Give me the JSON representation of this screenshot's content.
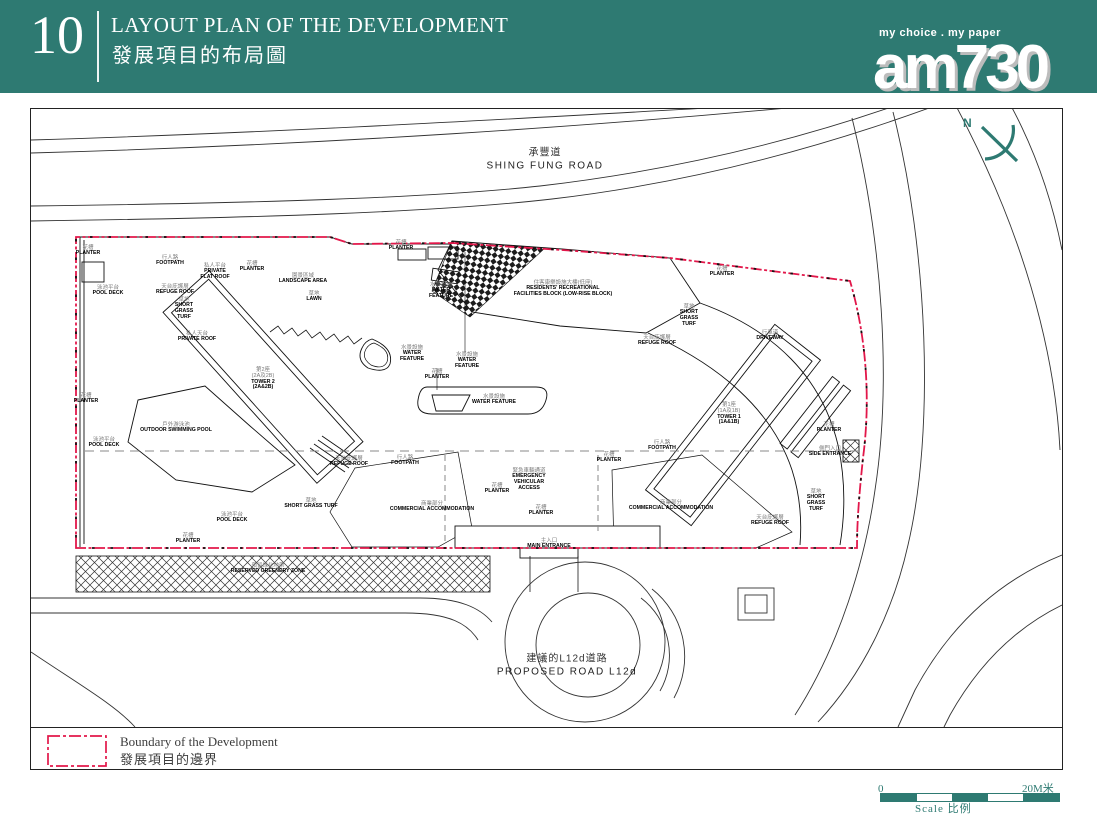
{
  "header": {
    "page_number": "10",
    "title_en": "LAYOUT PLAN OF THE DEVELOPMENT",
    "title_zh": "發展項目的布局圖",
    "tagline": "my choice . my paper",
    "logo_text": "am730"
  },
  "plan": {
    "north_label": "N",
    "road_labels": [
      {
        "zh": "承豐道",
        "en": "SHING FUNG ROAD",
        "x": 545,
        "y": 160
      },
      {
        "zh": "建議的L12d道路",
        "en": "PROPOSED ROAD L12d",
        "x": 567,
        "y": 666
      }
    ],
    "labels": [
      {
        "zh": "花槽",
        "en": "PLANTER",
        "x": 88,
        "y": 251
      },
      {
        "zh": "泳池平台",
        "en": "POOL DECK",
        "x": 108,
        "y": 291
      },
      {
        "zh": "行人路",
        "en": "FOOTPATH",
        "x": 170,
        "y": 261
      },
      {
        "zh": "私人平台",
        "en": "PRIVATE\nFLAT ROOF",
        "x": 215,
        "y": 272
      },
      {
        "zh": "花槽",
        "en": "PLANTER",
        "x": 252,
        "y": 267
      },
      {
        "zh": "天台庇護層",
        "en": "REFUGE ROOF",
        "x": 175,
        "y": 290
      },
      {
        "zh": "草地",
        "en": "SHORT\nGRASS\nTURF",
        "x": 184,
        "y": 309
      },
      {
        "zh": "私人天台",
        "en": "PRIVATE ROOF",
        "x": 197,
        "y": 337
      },
      {
        "zh": "第2座\n(2A及2B)",
        "en": "TOWER 2\n(2A&2B)",
        "x": 263,
        "y": 379
      },
      {
        "zh": "園景區域",
        "en": "LANDSCAPE AREA",
        "x": 303,
        "y": 279
      },
      {
        "zh": "草地",
        "en": "LAWN",
        "x": 314,
        "y": 297
      },
      {
        "zh": "花槽",
        "en": "PLANTER",
        "x": 401,
        "y": 246
      },
      {
        "zh": "水景設施",
        "en": "WATER\nFEATURE",
        "x": 441,
        "y": 291
      },
      {
        "zh": "水景設施",
        "en": "WATER\nFEATURE",
        "x": 412,
        "y": 354
      },
      {
        "zh": "水景設施",
        "en": "WATER\nFEATURE",
        "x": 467,
        "y": 361
      },
      {
        "zh": "花槽",
        "en": "PLANTER",
        "x": 437,
        "y": 375
      },
      {
        "zh": "水景設施",
        "en": "WATER FEATURE",
        "x": 494,
        "y": 400
      },
      {
        "zh": "住客康樂設施大樓(低座)",
        "en": "RESIDENTS' RECREATIONAL\nFACILITIES BLOCK (LOW-RISE BLOCK)",
        "x": 563,
        "y": 289
      },
      {
        "zh": "花槽",
        "en": "PLANTER",
        "x": 722,
        "y": 272
      },
      {
        "zh": "草地",
        "en": "SHORT\nGRASS\nTURF",
        "x": 689,
        "y": 316
      },
      {
        "zh": "天台庇護層",
        "en": "REFUGE ROOF",
        "x": 657,
        "y": 341
      },
      {
        "zh": "行車道",
        "en": "DRIVEWAY",
        "x": 770,
        "y": 336
      },
      {
        "zh": "第1座\n(1A及1B)",
        "en": "TOWER 1\n(1A&1B)",
        "x": 729,
        "y": 414
      },
      {
        "zh": "花槽",
        "en": "PLANTER",
        "x": 829,
        "y": 428
      },
      {
        "zh": "側門入口",
        "en": "SIDE ENTRANCE",
        "x": 830,
        "y": 452
      },
      {
        "zh": "草地",
        "en": "SHORT\nGRASS\nTURF",
        "x": 816,
        "y": 501
      },
      {
        "zh": "天台庇護層",
        "en": "REFUGE ROOF",
        "x": 770,
        "y": 521
      },
      {
        "zh": "行人路",
        "en": "FOOTPATH",
        "x": 662,
        "y": 446
      },
      {
        "zh": "花槽",
        "en": "PLANTER",
        "x": 609,
        "y": 458
      },
      {
        "zh": "緊急車輛通道",
        "en": "EMERGENCY\nVEHICULAR\nACCESS",
        "x": 529,
        "y": 480
      },
      {
        "zh": "花槽",
        "en": "PLANTER",
        "x": 497,
        "y": 489
      },
      {
        "zh": "花槽",
        "en": "PLANTER",
        "x": 541,
        "y": 511
      },
      {
        "zh": "商業部分",
        "en": "COMMERCIAL ACCOMMODATION",
        "x": 432,
        "y": 507
      },
      {
        "zh": "商業部分",
        "en": "COMMERCIAL ACCOMMODATION",
        "x": 671,
        "y": 506
      },
      {
        "zh": "主入口",
        "en": "MAIN ENTRANCE",
        "x": 549,
        "y": 544
      },
      {
        "zh": "行人路",
        "en": "FOOTPATH",
        "x": 405,
        "y": 461
      },
      {
        "zh": "草地",
        "en": "SHORT GRASS TURF",
        "x": 311,
        "y": 504
      },
      {
        "zh": "天台庇護層",
        "en": "REFUGE ROOF",
        "x": 349,
        "y": 462
      },
      {
        "zh": "戶外游泳池",
        "en": "OUTDOOR SWIMMING POOL",
        "x": 176,
        "y": 428
      },
      {
        "zh": "泳池平台",
        "en": "POOL DECK",
        "x": 104,
        "y": 443
      },
      {
        "zh": "泳池平台",
        "en": "POOL DECK",
        "x": 232,
        "y": 518
      },
      {
        "zh": "花槽",
        "en": "PLANTER",
        "x": 86,
        "y": 399
      },
      {
        "zh": "花槽",
        "en": "PLANTER",
        "x": 188,
        "y": 539
      },
      {
        "zh": "預留綠化地帶",
        "en": "RESERVED GREENERY ZONE",
        "x": 268,
        "y": 569
      }
    ],
    "legend": {
      "label_en": "Boundary of the Development",
      "label_zh": "發展項目的邊界"
    },
    "scale": {
      "start": "0",
      "end": "20M米",
      "caption": "Scale 比例"
    }
  },
  "colors": {
    "band": "#2e7a72",
    "boundary": "#e2174a"
  }
}
